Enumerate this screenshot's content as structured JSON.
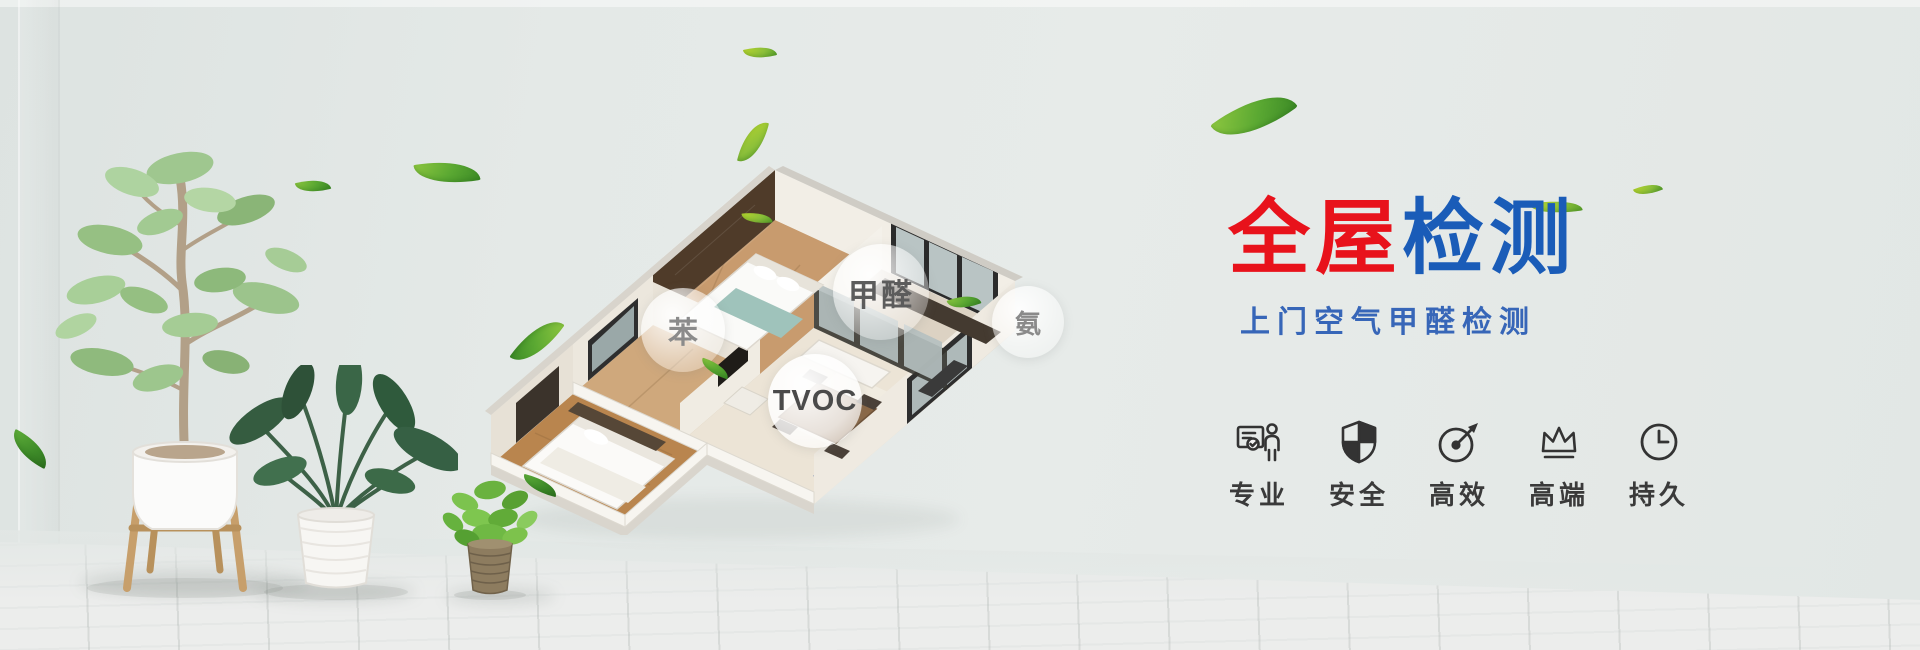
{
  "banner": {
    "title": {
      "red_text": "全屋",
      "blue_text": "检测",
      "red_color": "#e8121b",
      "blue_color": "#1a5cb8"
    },
    "subtitle": {
      "text": "上门空气甲醛检测",
      "color": "#3766b8"
    },
    "pollutant_labels": [
      {
        "id": "benzene",
        "text": "苯"
      },
      {
        "id": "formaldehyde",
        "text": "甲醛"
      },
      {
        "id": "ammonia",
        "text": "氨"
      },
      {
        "id": "tvoc",
        "text": "TVOC"
      }
    ],
    "features": [
      {
        "icon": "id-badge-person-icon",
        "label": "专业"
      },
      {
        "icon": "shield-icon",
        "label": "安全"
      },
      {
        "icon": "gauge-icon",
        "label": "高效"
      },
      {
        "icon": "crown-icon",
        "label": "高端"
      },
      {
        "icon": "clock-icon",
        "label": "持久"
      }
    ],
    "colors": {
      "wall": "#e4e9e7",
      "floor": "#e8e9e8",
      "leaf_green": "#6fbf2e",
      "icon_dark": "#333333",
      "bubble_text": "#6e6e6e"
    }
  }
}
